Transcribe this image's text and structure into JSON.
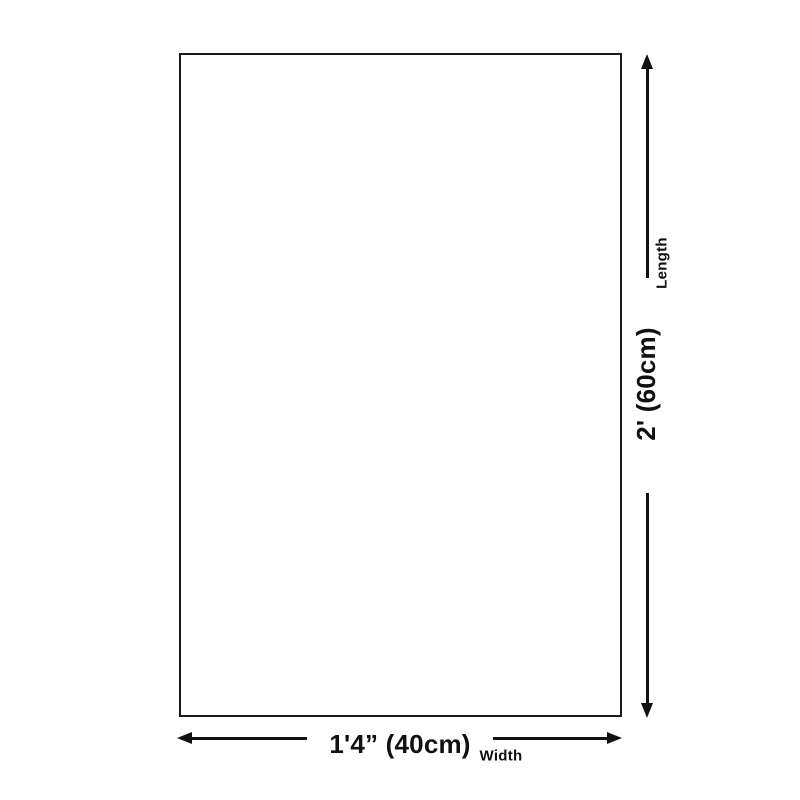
{
  "page": {
    "background": "#ffffff",
    "ink": "#111111",
    "outline_color": "#1a1a1a"
  },
  "diagram": {
    "length": {
      "label": "Length",
      "value": "2' (60cm)"
    },
    "width": {
      "label": "Width",
      "value": "1'4” (40cm)"
    },
    "icons": {
      "up": "arrow-up-icon",
      "down": "arrow-down-icon",
      "left": "arrow-left-icon",
      "right": "arrow-right-icon"
    }
  }
}
